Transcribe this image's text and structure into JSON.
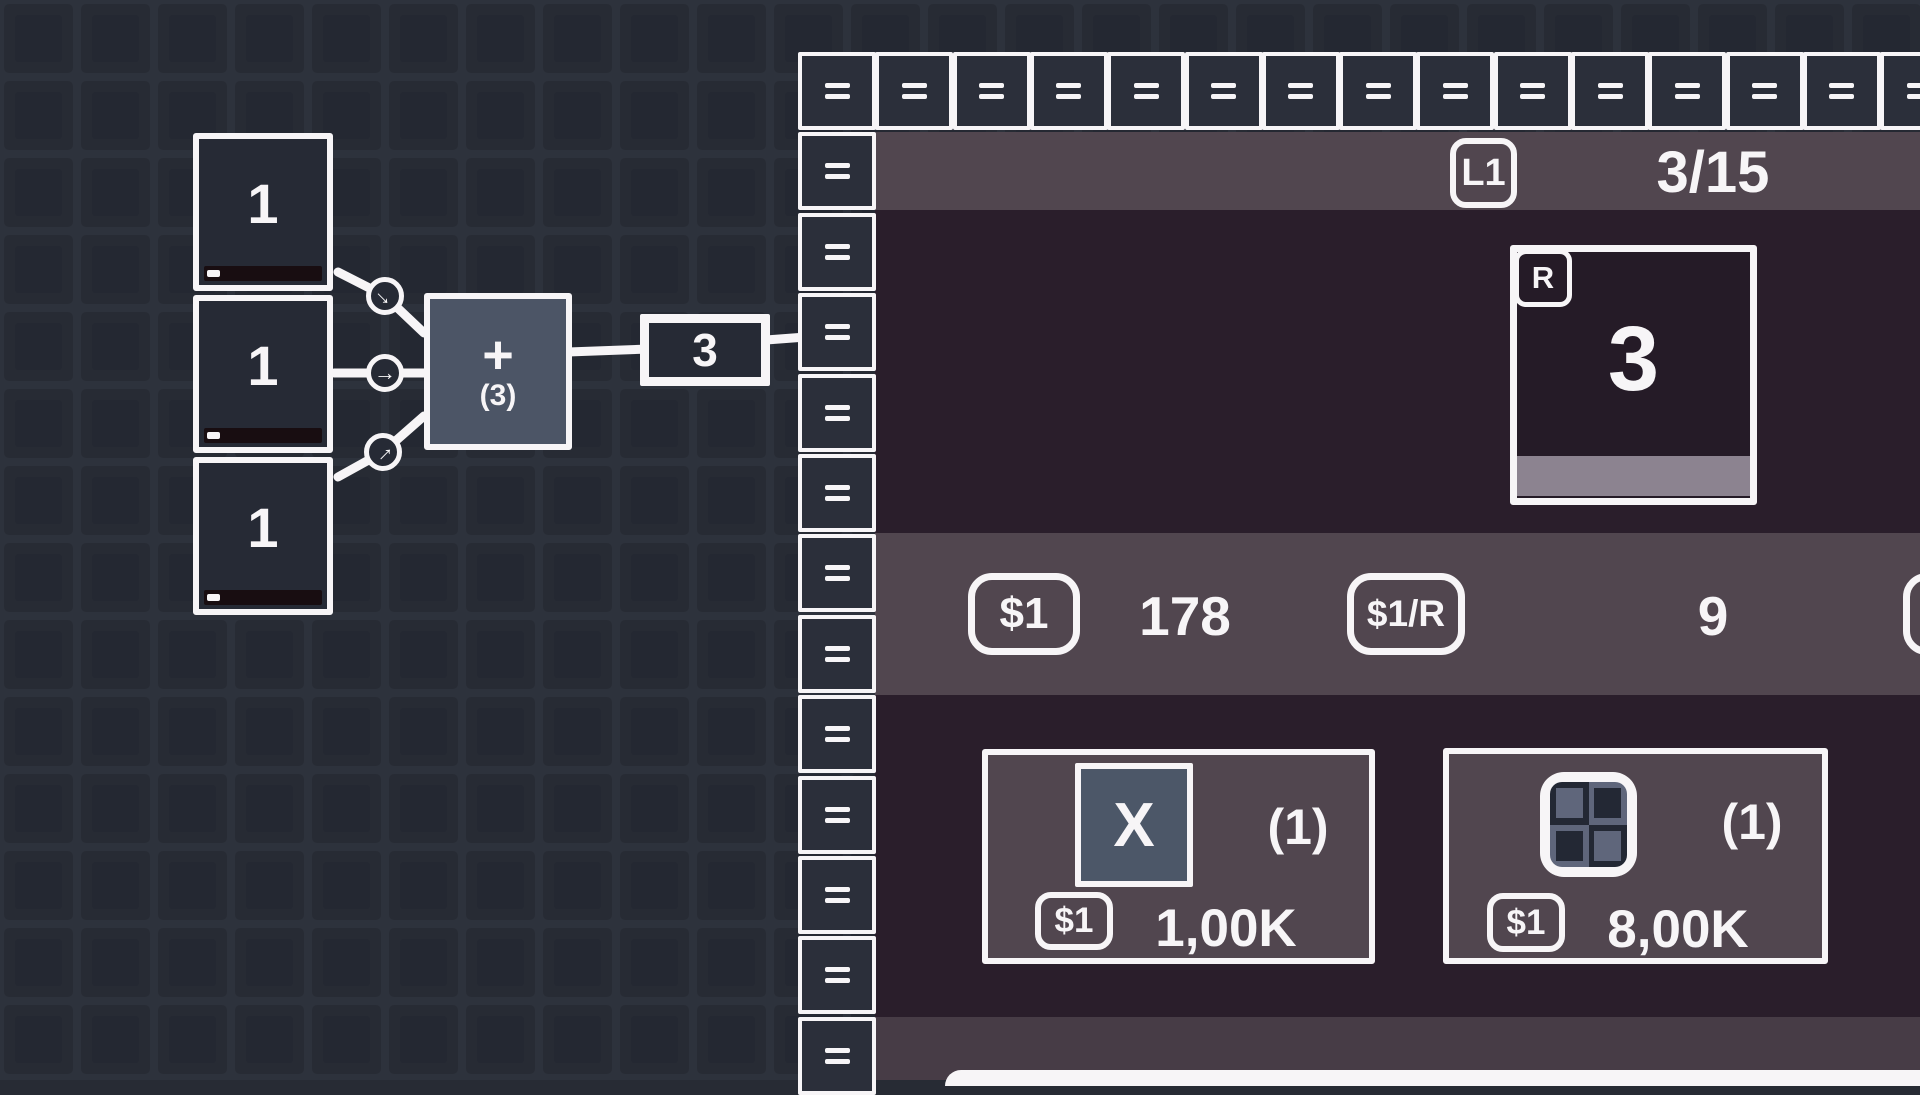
{
  "canvas": {
    "input_nodes": [
      {
        "value": "1"
      },
      {
        "value": "1"
      },
      {
        "value": "1"
      }
    ],
    "operator_node": {
      "operator": "+",
      "buffer": "(3)"
    },
    "output_value_box": {
      "value": "3"
    },
    "arrow_glyph": "→",
    "connectors": [
      {
        "direction": "down-right"
      },
      {
        "direction": "right"
      },
      {
        "direction": "up-right"
      }
    ]
  },
  "panel": {
    "border": {
      "symbol": "=",
      "top_count": 15,
      "left_count": 12
    },
    "header": {
      "level_badge": "L1",
      "counter": "3/15"
    },
    "resource_card": {
      "badge": "R",
      "value": "3"
    },
    "stats": {
      "money": {
        "badge": "$1",
        "value": "178"
      },
      "rate": {
        "badge": "$1/R",
        "value": "9"
      },
      "partial_badge": {
        "badge": ""
      }
    },
    "shop": {
      "items": [
        {
          "icon": "multiply-node-icon",
          "icon_label": "X",
          "count": "(1)",
          "currency_badge": "$1",
          "price": "1,00K"
        },
        {
          "icon": "grid-tiles-icon",
          "count": "(1)",
          "currency_badge": "$1",
          "price": "8,00K"
        }
      ]
    }
  },
  "colors": {
    "background_base": "#272b34",
    "background_tile": "#272b34",
    "background_tile_line": "#2d323c",
    "background_tile_inner": "#242832",
    "white_ink": "#f7f5f7",
    "node_fill": "#262a35",
    "operator_node_fill": "#4c5566",
    "progress_track": "#180d11",
    "panel_dark": "#2a1e2b",
    "panel_band": "#51464f",
    "panel_band_bottom": "#473c46",
    "border_square_fill": "#2b2f3a",
    "resource_card_fill": "#251b27",
    "resource_progress": "#8c8390",
    "icon_slate": "#4c5768",
    "grid_icon_dark": "#232834",
    "grid_icon_slate": "#5f667b"
  }
}
